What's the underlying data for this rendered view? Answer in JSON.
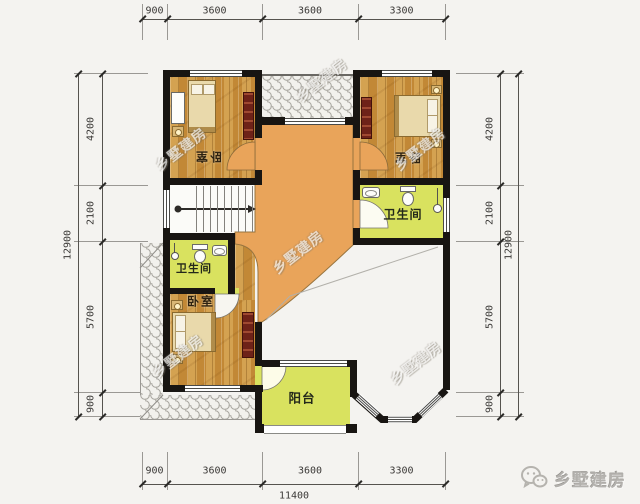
{
  "dimensions": {
    "top": [
      "900",
      "3600",
      "3600",
      "3300"
    ],
    "bottom": [
      "900",
      "3600",
      "3600",
      "3300"
    ],
    "bottom_total": "11400",
    "left": [
      "4200",
      "2100",
      "5700",
      "900"
    ],
    "left_total": "12900",
    "right": [
      "4200",
      "2100",
      "5700",
      "900"
    ],
    "right_total": "12900"
  },
  "rooms": {
    "bedroom_top_left": "卧室",
    "bedroom_top_right": "卧室",
    "bedroom_bottom_left": "卧室",
    "bathroom_right": "卫生间",
    "bathroom_left": "卫生间",
    "balcony": "阳台"
  },
  "watermark_text": "乡墅建房",
  "footer_logo_text": "乡墅建房",
  "colors": {
    "hall_floor": "#e9a45a",
    "wet_room": "#d9e25f",
    "wood_floor": "#cc9342",
    "wall": "#181512"
  }
}
